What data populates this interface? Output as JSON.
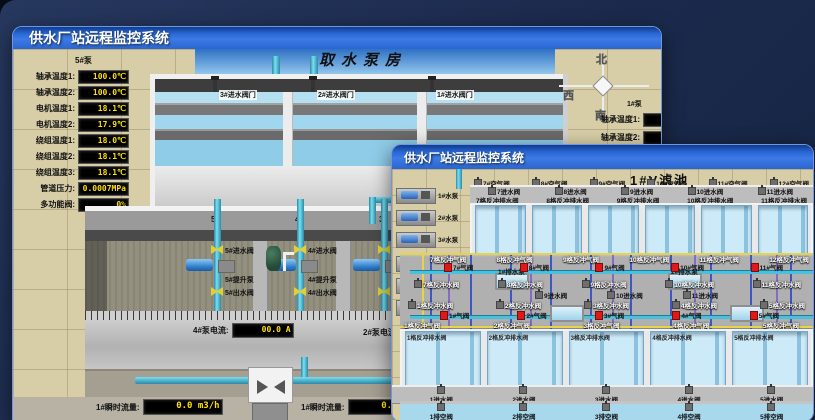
{
  "back_window": {
    "title": "供水厂站远程监控系统",
    "scene_title": "取水泵房",
    "pump5_panel": {
      "heading": "5#泵",
      "rows": [
        {
          "label": "轴承温度1:",
          "value": "100.0℃"
        },
        {
          "label": "轴承温度2:",
          "value": "100.0℃"
        },
        {
          "label": "电机温度1:",
          "value": "18.1℃"
        },
        {
          "label": "电机温度2:",
          "value": "17.9℃"
        },
        {
          "label": "绕组温度1:",
          "value": "18.0℃"
        },
        {
          "label": "绕组温度2:",
          "value": "18.1℃"
        },
        {
          "label": "绕组温度3:",
          "value": "18.1℃"
        },
        {
          "label": "管道压力:",
          "value": "0.0007MPa"
        },
        {
          "label": "多功能阀:",
          "value": "0%"
        }
      ]
    },
    "intake_valves": [
      "3#进水阀门",
      "2#进水阀门",
      "1#进水阀门"
    ],
    "compass": {
      "north": "北",
      "west": "西",
      "south": "南"
    },
    "pump1_panel": {
      "heading": "1#泵",
      "rows": [
        {
          "label": "轴承温度1:"
        },
        {
          "label": "轴承温度2:"
        }
      ]
    },
    "pump_hall": {
      "bays": [
        {
          "no": "5#",
          "inlet_valve": "5#进水阀",
          "pump": "5#提升泵",
          "outlet_valve": "5#出水阀"
        },
        {
          "no": "4#",
          "inlet_valve": "4#进水阀",
          "pump": "4#提升泵",
          "outlet_valve": "4#出水阀"
        },
        {
          "no": "3#",
          "inlet_valve": "3#进水阀",
          "pump": "3#提升泵",
          "outlet_valve": "3#出水阀"
        },
        {
          "no": "2#",
          "inlet_valve": "2#进水阀",
          "pump": "2#提升泵",
          "outlet_valve": "2#出水阀"
        }
      ],
      "current_meters": [
        {
          "label": "4#泵电流:",
          "value": "00.0 A"
        },
        {
          "label": "2#泵电流:",
          "value": "00.0 A"
        }
      ]
    },
    "flow_meters": [
      {
        "label": "1#瞬时流量:",
        "value": "0.0 m3/h"
      },
      {
        "label": "1#瞬时流量:",
        "value": "0.0 m3/h"
      }
    ]
  },
  "front_window": {
    "title": "供水厂站远程监控系统",
    "scene_title": "1#V滤池",
    "machines": [
      "1#水泵",
      "2#水泵",
      "3#水泵",
      "1#风机",
      "2#风机",
      "3#风机"
    ],
    "sump_pumps": [
      "1#排水泵",
      "2#排水泵"
    ],
    "rows": {
      "air_top": [
        "7#空气阀",
        "8#空气阀",
        "9#空气阀",
        "10#空气阀",
        "11#空气阀",
        "12#空气阀"
      ],
      "inlet_top": [
        "7进水阀",
        "8进水阀",
        "9进水阀",
        "10进水阀",
        "11进水阀"
      ],
      "drain_top": [
        "7格反冲排水阀",
        "8格反冲排水阀",
        "9格反冲排水阀",
        "10格反冲排水阀",
        "11格反冲排水阀"
      ],
      "bw_air_top": [
        "7格反冲气阀",
        "8格反冲气阀",
        "9格反冲气阀",
        "10格反冲气阀",
        "11格反冲气阀",
        "12格反冲气阀"
      ],
      "air_valve_top": [
        "7#气阀",
        "8#气阀",
        "9#气阀",
        "10#气阀",
        "11#气阀"
      ],
      "bw_water_top": [
        "7格反冲水阀",
        "8格反冲水阀",
        "9格反冲水阀",
        "10格反冲水阀",
        "11格反冲水阀"
      ],
      "inlet_mid": [
        "9进水阀",
        "10进水阀",
        "11进水阀"
      ],
      "bw_water_bottom": [
        "1格反冲水阀",
        "2格反冲水阀",
        "3格反冲水阀",
        "4格反冲水阀",
        "5格反冲水阀"
      ],
      "air_valve_bottom": [
        "1#气阀",
        "2#气阀",
        "3#气阀",
        "4#气阀",
        "5#气阀"
      ],
      "bw_air_bottom": [
        "1格反冲气阀",
        "2格反冲气阀",
        "3格反冲气阀",
        "4格反冲气阀",
        "5格反冲气阀"
      ],
      "drain_bottom": [
        "1格反冲排水阀",
        "2格反冲排水阀",
        "3格反冲排水阀",
        "4格反冲排水阀",
        "5格反冲排水阀"
      ],
      "inlet_bottom": [
        "1进水阀",
        "2进水阀",
        "3进水阀",
        "4进水阀",
        "5进水阀"
      ],
      "vent_bottom": [
        "1排空阀",
        "2排空阀",
        "3排空阀",
        "4排空阀",
        "5排空阀"
      ]
    }
  },
  "colors": {
    "header_blue": "#2f6fdd",
    "led_text": "#ffe000",
    "pipe_cyan": "#49c0dc",
    "valve_red": "#e01818",
    "valve_yellow": "#e3cf34",
    "line_blue": "#2b46c8",
    "line_purple": "#7a52cc",
    "line_yellow": "#e8d44a"
  }
}
